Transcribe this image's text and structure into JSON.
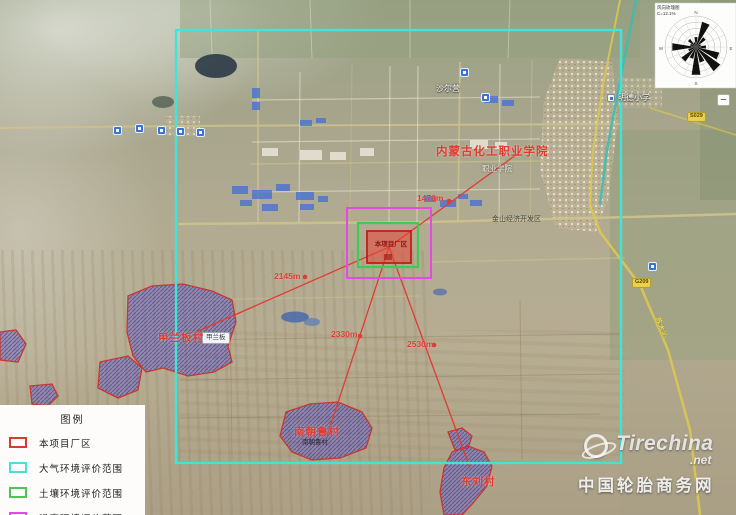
{
  "windrose": {
    "note1": "风向玫瑰图",
    "note2": "C=12.1%",
    "n": "N",
    "e": "E",
    "s": "S",
    "w": "W"
  },
  "map_controls": {
    "zoom_out": "−"
  },
  "project": {
    "label": "本项目厂区"
  },
  "sensitive_points": [
    {
      "name": "内蒙古化工职业学院",
      "distance": "1470m"
    },
    {
      "name": "甲兰板村",
      "distance": "2145m"
    },
    {
      "name": "南朝鲁村",
      "distance": "2330m"
    },
    {
      "name": "东刘村",
      "distance": "2530m"
    }
  ],
  "base_labels": {
    "place_top": "沙尔营",
    "school_right": "明德小学",
    "vocational_school": "职业学院",
    "industrial_zone": "金山经济开发区",
    "village_tag": "甲兰板",
    "village_south_tag": "南朝鲁村",
    "road_g209": "G209",
    "road_s029": "S029",
    "road_name_right": "苏木沁"
  },
  "legend": {
    "title": "图例",
    "items": [
      {
        "label": "本项目厂区",
        "color": "#d93a2e"
      },
      {
        "label": "大气环境评价范围",
        "color": "#46e2d6"
      },
      {
        "label": "土壤环境评价范围",
        "color": "#4ec452"
      },
      {
        "label": "噪声环境评价范围",
        "color": "#e24ae2"
      }
    ]
  },
  "watermark": {
    "brand": "Tirechina",
    "tld": ".net",
    "subtitle": "中国轮胎商务网"
  }
}
